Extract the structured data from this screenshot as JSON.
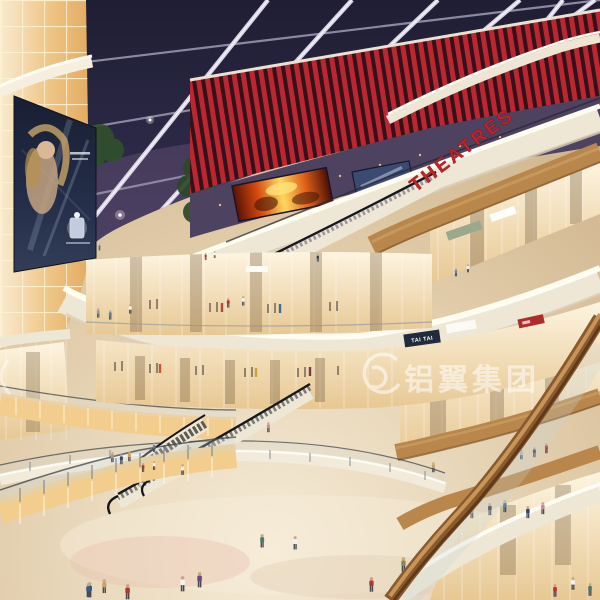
{
  "scene": {
    "description": "Night-time interior rendering of a multi-level shopping mall atrium with curved balconies, escalators, glowing storefronts and a skylight grid ceiling",
    "levels_visible": 5
  },
  "signs": {
    "theatres": "THEATRES",
    "store": "TAI TAI",
    "watermark": "铝翼集团"
  },
  "billboard": {
    "type": "perfume-advertisement"
  },
  "colors": {
    "sign_red": "#c2242c",
    "slat_red": "#bc2630",
    "night_sky": "#2a2944",
    "beam": "#d6d1e4",
    "cream": "#efe7d5",
    "wood": "#b9874c",
    "amber_glow": "#f2cd8e",
    "floor": "#ddc9a6",
    "watermark_white": "#ffffff"
  }
}
